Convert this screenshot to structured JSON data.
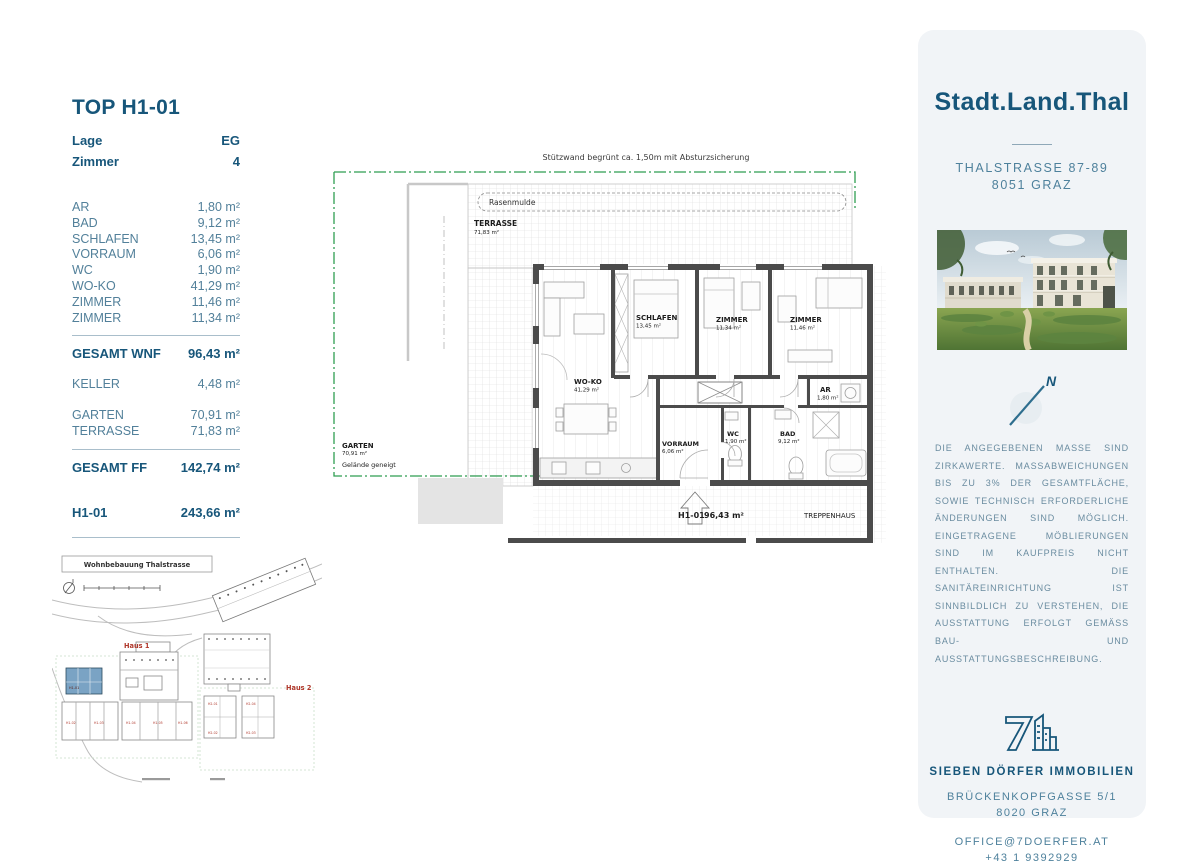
{
  "unit_info": {
    "title": "TOP H1-01",
    "attributes": [
      {
        "label": "Lage",
        "value": "EG"
      },
      {
        "label": "Zimmer",
        "value": "4"
      }
    ],
    "rooms": [
      {
        "label": "AR",
        "value": "1,80 m²"
      },
      {
        "label": "BAD",
        "value": "9,12 m²"
      },
      {
        "label": "SCHLAFEN",
        "value": "13,45 m²"
      },
      {
        "label": "VORRAUM",
        "value": "6,06 m²"
      },
      {
        "label": "WC",
        "value": "1,90 m²"
      },
      {
        "label": "WO-KO",
        "value": "41,29 m²"
      },
      {
        "label": "ZIMMER",
        "value": "11,46 m²"
      },
      {
        "label": "ZIMMER",
        "value": "11,34 m²"
      }
    ],
    "gesamt_wnf": {
      "label": "GESAMT WNF",
      "value": "96,43 m²"
    },
    "keller": {
      "label": "KELLER",
      "value": "4,48 m²"
    },
    "outdoor": [
      {
        "label": "GARTEN",
        "value": "70,91 m²"
      },
      {
        "label": "TERRASSE",
        "value": "71,83 m²"
      }
    ],
    "gesamt_ff": {
      "label": "GESAMT FF",
      "value": "142,74 m²"
    },
    "unit_total": {
      "label": "H1-01",
      "value": "243,66 m²"
    }
  },
  "floorplan": {
    "note": "Stützwand begrünt ca. 1,50m mit Absturzsicherung",
    "rasenmulde": "Rasenmulde",
    "terrasse": {
      "name": "TERRASSE",
      "area": "71,83 m²"
    },
    "garten": {
      "name": "GARTEN",
      "area": "70,91 m²",
      "note": "Gelände geneigt"
    },
    "wo_ko": {
      "name": "WO-KO",
      "area": "41,29 m²"
    },
    "schlafen": {
      "name": "SCHLAFEN",
      "area": "13,45 m²"
    },
    "zimmer1": {
      "name": "ZIMMER",
      "area": "11,34 m²"
    },
    "zimmer2": {
      "name": "ZIMMER",
      "area": "11,46 m²"
    },
    "ar": {
      "name": "AR",
      "area": "1,80 m²"
    },
    "vorraum": {
      "name": "VORRAUM",
      "area": "6,06 m²"
    },
    "wc": {
      "name": "WC",
      "area": "1,90 m²"
    },
    "bad": {
      "name": "BAD",
      "area": "9,12 m²"
    },
    "unit_code": "H1-01",
    "unit_area": "96,43 m²",
    "treppenhaus": "TREPPENHAUS"
  },
  "siteplan": {
    "title": "Wohnbebauung Thalstrasse",
    "haus1": "Haus 1",
    "haus2": "Haus 2",
    "h1_units": [
      "H1-01",
      "H1-02",
      "H1-03",
      "H1-04",
      "H1-05",
      "H1-06"
    ],
    "h2_units": [
      "H2-01",
      "H2-04",
      "H2-02",
      "H2-03"
    ]
  },
  "sidebar": {
    "brand": "Stadt.Land.Thal",
    "address_line1": "THALSTRASSE 87-89",
    "address_line2": "8051 GRAZ",
    "compass_label": "N",
    "disclaimer": "DIE ANGEGEBENEN MASSE SIND ZIRKAWERTE. MASSABWEICHUNGEN BIS ZU 3% DER GESAMTFLÄCHE, SOWIE TECHNISCH ERFORDERLICHE ÄNDERUNGEN SIND MÖGLICH. EINGETRAGENE MÖBLIERUNGEN SIND IM KAUFPREIS NICHT ENTHALTEN. DIE SANITÄREINRICHTUNG IST SINNBILDLICH ZU VERSTEHEN, DIE AUSSTATTUNG ERFOLGT GEMÄSS BAU- UND AUSSTATTUNGSBESCHREIBUNG.",
    "company": "SIEBEN DÖRFER IMMOBILIEN",
    "company_address1": "BRÜCKENKOPFGASSE 5/1",
    "company_address2": "8020 GRAZ",
    "email": "OFFICE@7DOERFER.AT",
    "phone": "+43 1 9392929"
  },
  "colors": {
    "accent_dark": "#17567A",
    "accent_mid": "#4E819C",
    "card_bg": "#F1F4F7",
    "garden_green": "#2F9E52",
    "wall_gray": "#4B4B4B",
    "site_red": "#B0372B",
    "unit_blue": "#7AA3C4"
  }
}
